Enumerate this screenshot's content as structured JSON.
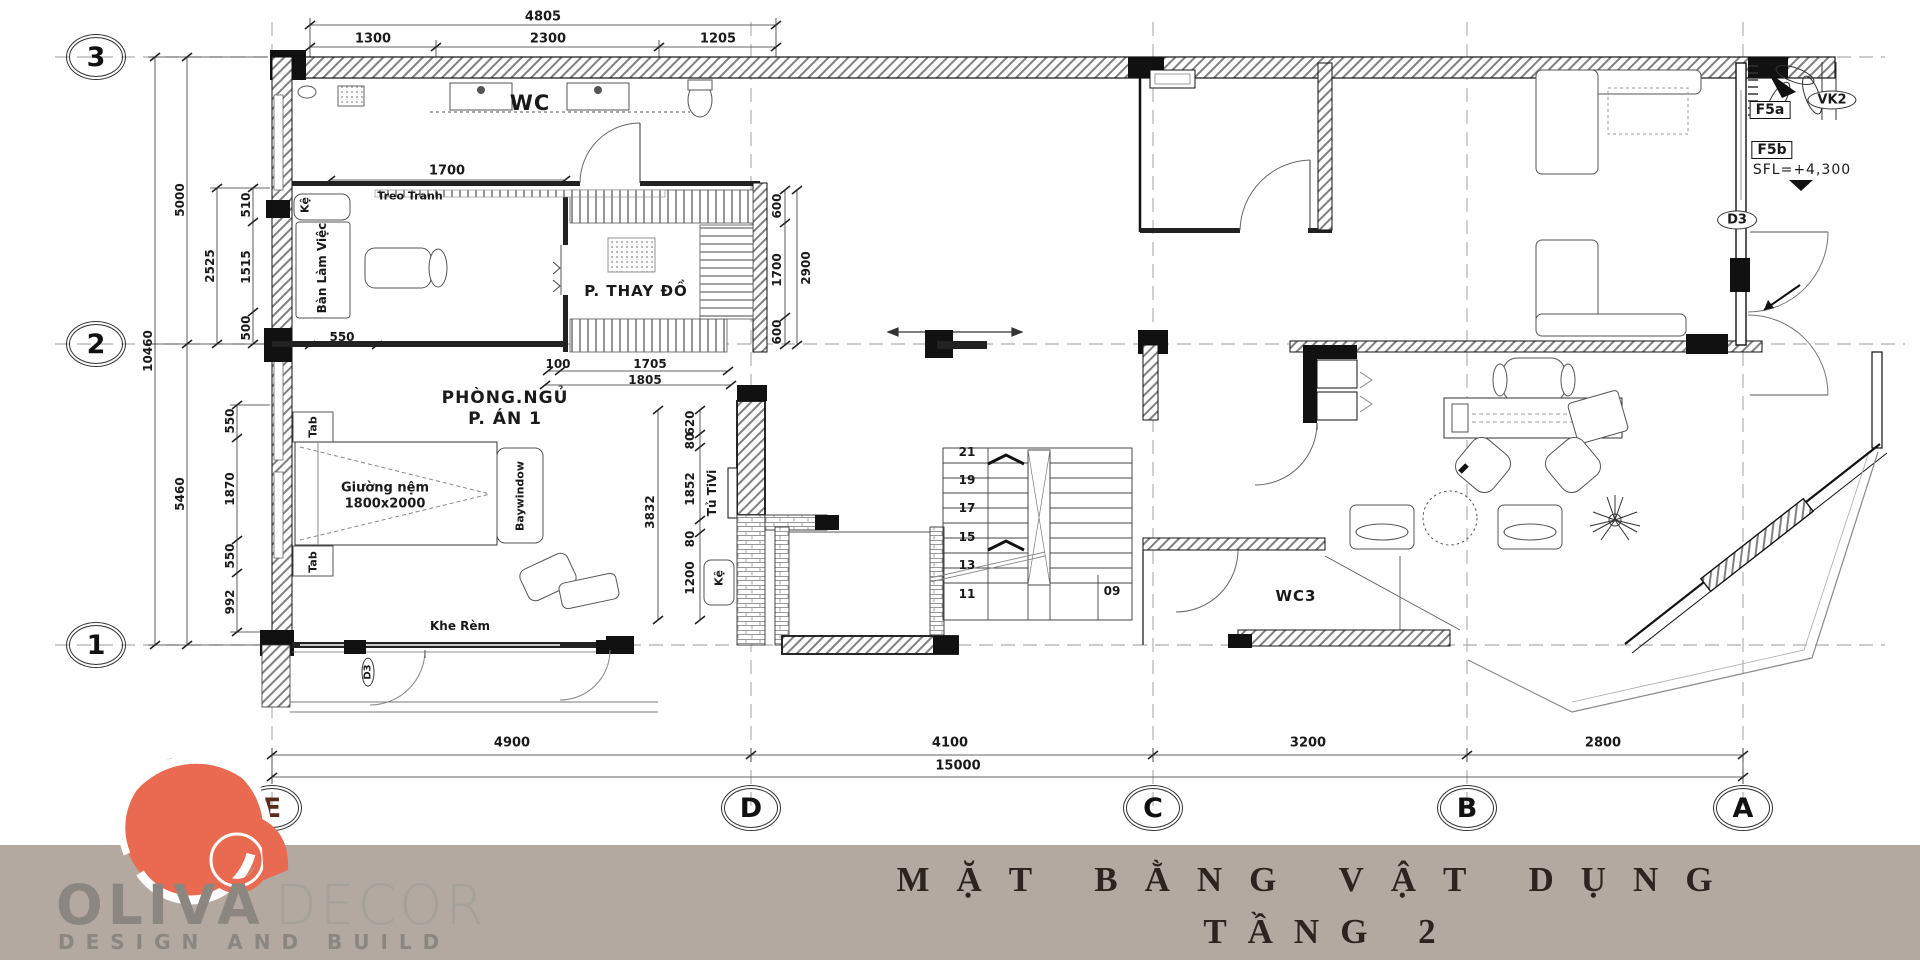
{
  "title": {
    "line1": "MẶT BẰNG VẬT DỤNG",
    "line2": "TẦNG 2"
  },
  "logo": {
    "brand_bold": "OLIVA",
    "brand_light": "DECOR",
    "tagline": "DESIGN AND BUILD"
  },
  "grid": {
    "rows": [
      "3",
      "2",
      "1"
    ],
    "cols": [
      "E",
      "D",
      "C",
      "B",
      "A"
    ]
  },
  "dims": {
    "top": [
      "4805",
      "1300",
      "2300",
      "1205"
    ],
    "left": [
      "5000",
      "10460",
      "5460",
      "2525",
      "510",
      "1515",
      "500",
      "550",
      "1870",
      "550",
      "992"
    ],
    "work": [
      "1700",
      "550"
    ],
    "dress": [
      "600",
      "1700",
      "600",
      "2900",
      "100",
      "1705",
      "1805"
    ],
    "mid": [
      "3832",
      "620",
      "80",
      "1852",
      "80",
      "1200"
    ],
    "bottom": [
      "4900",
      "4100",
      "3200",
      "2800",
      "15000"
    ]
  },
  "rooms": {
    "wc": "WC",
    "dressing": "P. THAY ĐỒ",
    "bedroom1": "PHÒNG.NGỦ",
    "bedroom2": "P. ÁN 1",
    "wc3": "WC3"
  },
  "labels": {
    "treo_tranh": "Treo Tranh",
    "ke": "Kệ",
    "ban_lam_viec": "Bàn Làm Việc",
    "tab_top": "Tab",
    "tab_bottom": "Tab",
    "bed1": "Giường nệm",
    "bed2": "1800x2000",
    "baywindow": "Baywindow",
    "khe_rem": "Khe Rèm",
    "tu_tivi": "Tủ TiVi",
    "ke_tv": "Kệ",
    "f5a": "F5a",
    "f5b": "F5b",
    "vk2": "VK2",
    "sfl": "SFL=+4,300",
    "d3": "D3",
    "d3_door": "D3"
  },
  "stairs": [
    "21",
    "19",
    "17",
    "15",
    "13",
    "11",
    "09"
  ],
  "colors": {
    "logo_red": "#e96a50",
    "logo_gray": "#8b8680",
    "band": "#b3a9a1"
  }
}
